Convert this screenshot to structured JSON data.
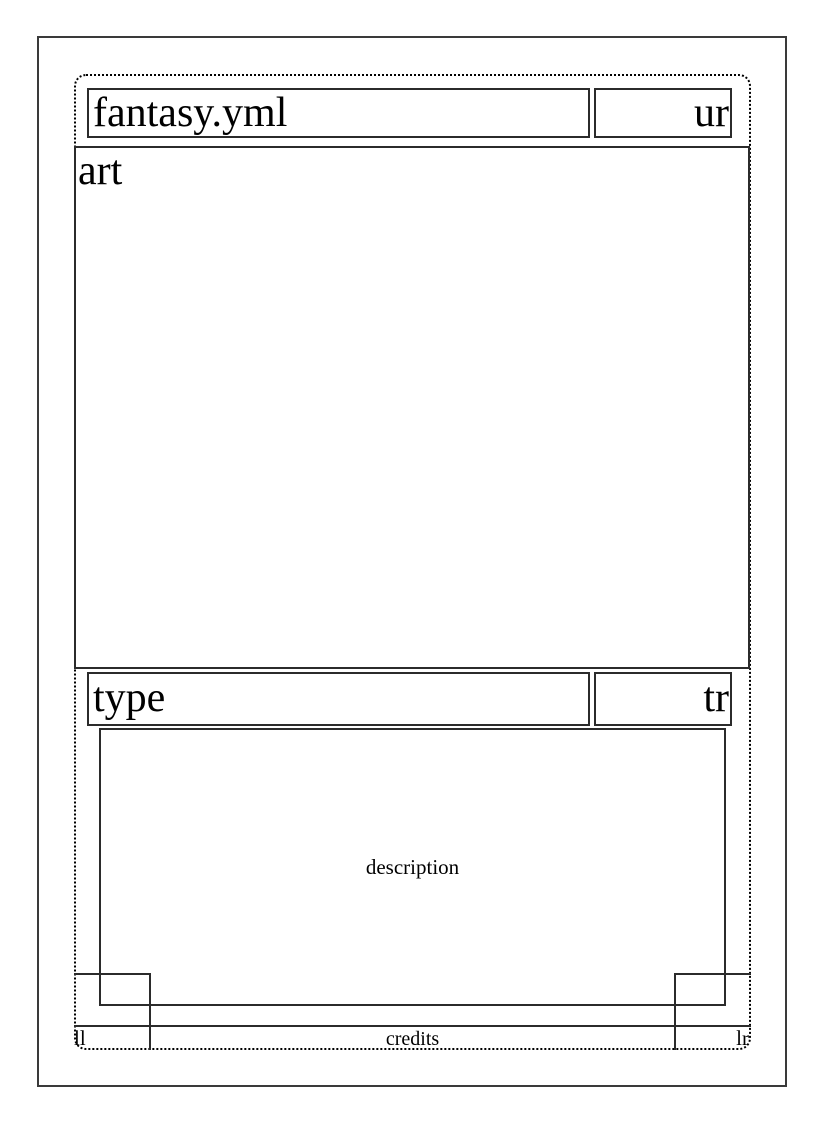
{
  "meta": {
    "template_file_label": "fantasy.yml"
  },
  "colors": {
    "line": "#2b2b2b",
    "dotted": "#000000",
    "text": "#000000",
    "background": "#ffffff",
    "page_border": "#3a3a3a"
  },
  "card": {
    "title": "fantasy.yml",
    "upper_right": "ur",
    "art_label": "art",
    "type_label": "type",
    "type_right": "tr",
    "description_label": "description",
    "lower_left": "ll",
    "credits_label": "credits",
    "lower_right": "lr"
  }
}
